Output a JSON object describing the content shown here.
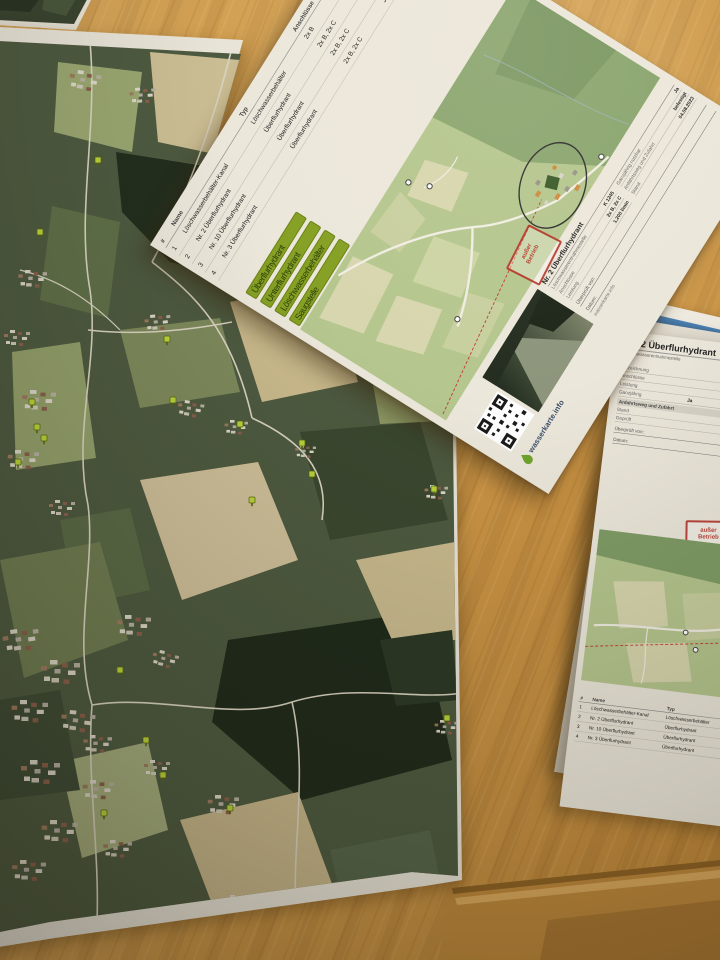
{
  "papers": {
    "overview_sheet": {
      "table": {
        "headers": [
          "#",
          "Name",
          "Typ",
          "Anschlüsse",
          "Ganzjährig",
          "Entfernung"
        ],
        "rows": [
          {
            "nr": "1",
            "name": "Löschwasserbehälter-Kanal",
            "typ": "Löschwasserbehälter",
            "ans": "2x B",
            "gj": "Ja",
            "ent": "410 m"
          },
          {
            "nr": "2",
            "name": "Nr. 2 Überflurhydrant",
            "typ": "Überflurhydrant",
            "ans": "2x B, 2x C",
            "gj": "Ja",
            "ent": "660 m"
          },
          {
            "nr": "3",
            "name": "Nr. 10 Überflurhydrant",
            "typ": "Überflurhydrant",
            "ans": "2x B, 2x C",
            "gj": "Ja",
            "ent": "380 m"
          },
          {
            "nr": "4",
            "name": "Nr. 3 Überflurhydrant",
            "typ": "Überflurhydrant",
            "ans": "2x B, 2x C",
            "gj": "Ja",
            "ent": "140 m"
          }
        ]
      },
      "legend": [
        "Überflurhydrant",
        "Unterflurhydrant",
        "Löschwasserbehälter",
        "Saugstelle"
      ],
      "info": {
        "title": "Nr. 2 Überflurhydrant",
        "fields": [
          {
            "label": "Löschwasserentnahmestelle",
            "value": "K 1245"
          },
          {
            "label": "Anschlüsse",
            "value": "2x B, 2x C"
          },
          {
            "label": "Leistung",
            "value": "1.200 l/min"
          },
          {
            "label": "Ganzjährig nutzbar",
            "value": "Ja"
          },
          {
            "label": "Anfahrtsweg und Zufahrt",
            "value": "befestigt"
          },
          {
            "label": "Stand",
            "value": "04.08.2023"
          }
        ],
        "sig1": "Überprüft von:",
        "sig2": "Datum:"
      },
      "stamp": {
        "line1": "außer",
        "line2": "Betrieb"
      },
      "qr_caption": "wasserkarte.info",
      "logo_text": "wasserkarte.info"
    },
    "detail_sheet": {
      "title": "Nr. 2 Überflurhydrant",
      "subtitle": "Löschwasserentnahmestelle",
      "fields": [
        {
          "label": "Bezeichnung",
          "value": "K 124"
        },
        {
          "label": "Anschlüsse",
          "value": "2x B, 2x C"
        },
        {
          "label": "Leistung",
          "value": "1.200 l/min"
        },
        {
          "label": "Ganzjährig",
          "value": "Ja"
        },
        {
          "label": "Stand",
          "value": "04.08.2023"
        },
        {
          "label": "Geprüft",
          "value": "12.05.2023"
        }
      ],
      "section": "Anfahrtsweg und Zufahrt",
      "status_chip": "einsatzbereit",
      "sig1": "Überprüft von:",
      "sig2": "Datum:",
      "stamp": {
        "line1": "außer",
        "line2": "Betrieb"
      },
      "table": {
        "headers": [
          "#",
          "Name",
          "Typ",
          "Anschlüsse",
          "Ganzjährig",
          "Entfernung"
        ],
        "rows": [
          {
            "nr": "1",
            "name": "Löschwasserbehälter-Kanal",
            "typ": "Löschwasserbehälter",
            "ans": "2x B",
            "gj": "Ja",
            "ent": "38 m"
          },
          {
            "nr": "2",
            "name": "Nr. 2 Überflurhydrant",
            "typ": "Überflurhydrant",
            "ans": "2x B, 2x C",
            "gj": "Ja",
            "ent": "81 m"
          },
          {
            "nr": "3",
            "name": "Nr. 10 Überflurhydrant",
            "typ": "Überflurhydrant",
            "ans": "2x B, 2x C",
            "gj": "Ja",
            "ent": "148 m"
          },
          {
            "nr": "4",
            "name": "Nr. 3 Überflurhydrant",
            "typ": "Überflurhydrant",
            "ans": "2x B, 2x C",
            "gj": "Ja",
            "ent": "153 m"
          }
        ]
      }
    },
    "under_sheet": {
      "header_text": "Maps"
    }
  },
  "icons": {
    "hydrant_marker": "lime map pin",
    "qr_code": "QR code",
    "logo_drop": "water drop",
    "stamp": "red stamp box",
    "circle_annotation": "ellipse highlight"
  },
  "colors": {
    "marker": "#b9d23c",
    "legend_chip": "#85a024",
    "stamp_red": "#b3281e",
    "sheet_map_green": "#b5c68e",
    "desk_wood": "#cd9849"
  }
}
